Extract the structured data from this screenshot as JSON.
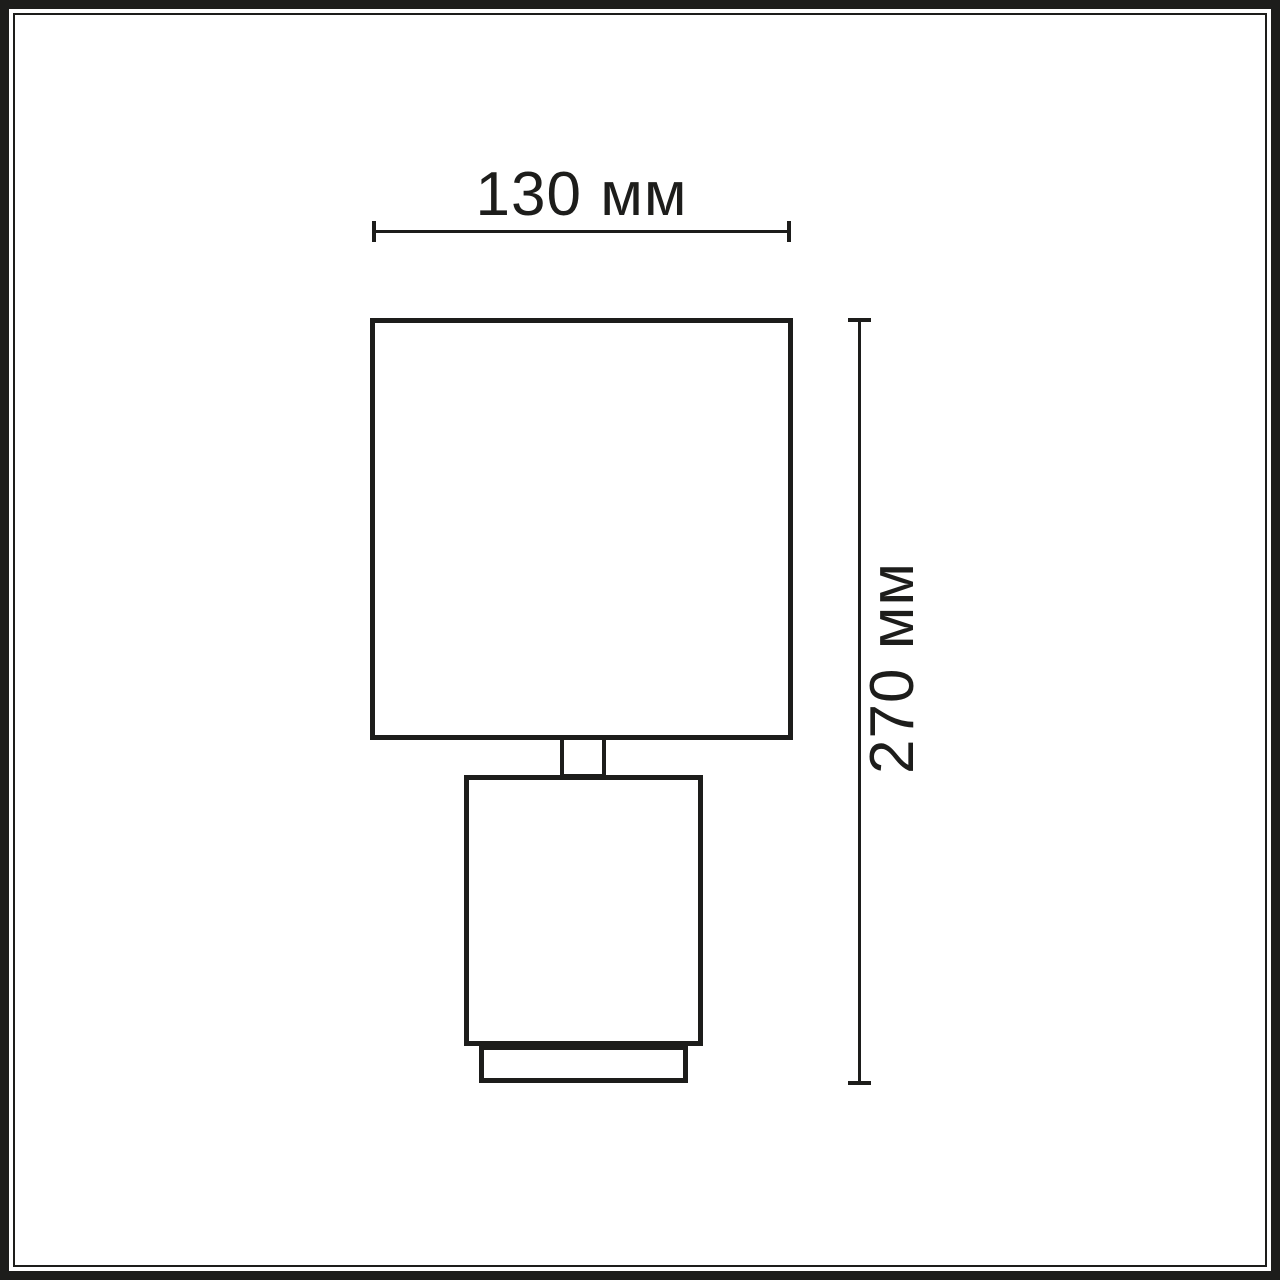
{
  "page": {
    "background_color": "#ffffff",
    "line_color": "#1d1d1b"
  },
  "drawing": {
    "subject": "table-lamp-front-elevation-dimension-drawing",
    "parts": [
      "lamp-shade",
      "lamp-neck",
      "lamp-base",
      "lamp-foot"
    ],
    "width_dimension": {
      "label": "130 мм",
      "value_mm": 130,
      "orientation": "horizontal"
    },
    "height_dimension": {
      "label": "270 мм",
      "value_mm": 270,
      "orientation": "vertical-rotated"
    }
  }
}
